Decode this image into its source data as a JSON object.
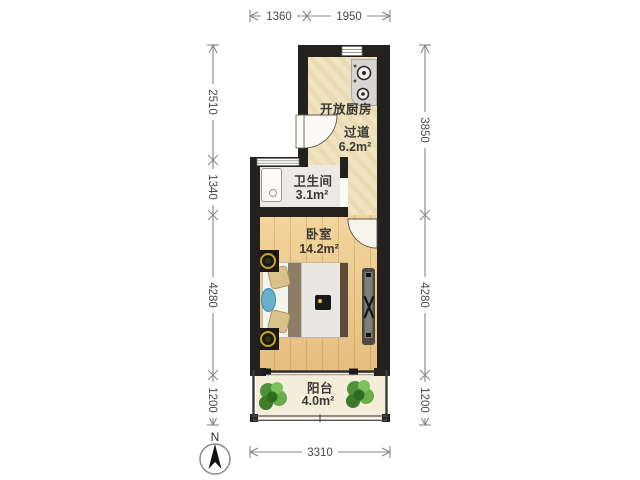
{
  "rooms": {
    "kitchen": {
      "name": "开放厨房"
    },
    "hallway": {
      "name": "过道",
      "area": "6.2m²"
    },
    "bathroom": {
      "name": "卫生间",
      "area": "3.1m²"
    },
    "bedroom": {
      "name": "卧室",
      "area": "14.2m²"
    },
    "balcony": {
      "name": "阳台",
      "area": "4.0m²"
    }
  },
  "dimensions": {
    "top": [
      "1360",
      "1950"
    ],
    "left": [
      "2510",
      "1340",
      "4280",
      "1200"
    ],
    "right": [
      "3850",
      "4280",
      "1200"
    ],
    "bottom": [
      "3310"
    ]
  },
  "compass": {
    "label": "N"
  },
  "icons": [
    "north-arrow",
    "stove-icon",
    "plant-icon",
    "radiator",
    "washer",
    "bed",
    "nightstand-lamp",
    "door-swing",
    "window"
  ],
  "colors": {
    "wall": "#23201d",
    "kitchen_floor": "#f0e3bf",
    "bathroom_floor": "#eceae5",
    "bedroom_floor": "#ecc98c",
    "balcony_floor": "#f3edda",
    "accent_gold": "#c9a227",
    "plant_green": "#559a3c",
    "dim_line": "#8a8784"
  }
}
